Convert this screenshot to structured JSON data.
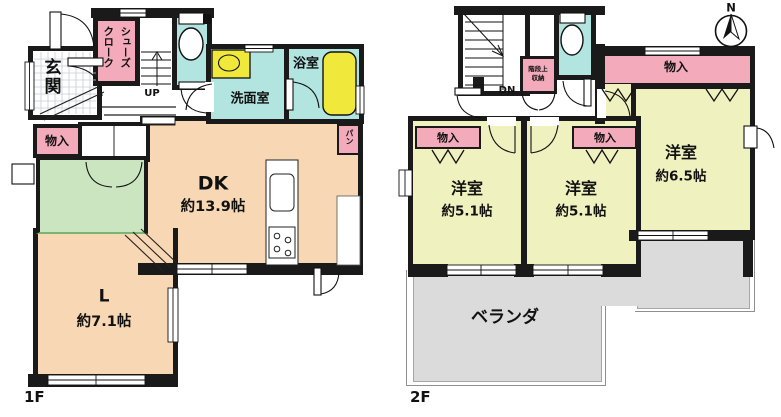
{
  "title": "間取り図 (floor plan)",
  "colors": {
    "wall": "#1a1a1a",
    "closet_pink": "#f3abbc",
    "wet_area_cyan": "#b2e4e0",
    "fixture_yellow": "#f0e93c",
    "ldk_peach": "#f8d8b4",
    "tatami_green": "#cbe5c0",
    "bedroom_yellow_green": "#eff1bf",
    "balcony_gray": "#dbdbdb"
  },
  "floor1": {
    "label": "1F",
    "entrance": "玄関",
    "shoe_closet_col1": "シューズ",
    "shoe_closet_col2": "クローク",
    "stairs": "UP",
    "washroom": "洗面室",
    "bathroom": "浴室",
    "storage": "物入",
    "pantry": "パン",
    "dining_kitchen": {
      "name": "DK",
      "size": "約13.9帖"
    },
    "living": {
      "name": "L",
      "size": "約7.1帖"
    }
  },
  "floor2": {
    "label": "2F",
    "stairs": "DN",
    "stair_storage": {
      "line1": "階段上",
      "line2": "収納"
    },
    "closet_room1": "物入",
    "closet_room2": "物入",
    "closet_room3": "物入",
    "room1": {
      "name": "洋室",
      "size": "約5.1帖"
    },
    "room2": {
      "name": "洋室",
      "size": "約5.1帖"
    },
    "room3": {
      "name": "洋室",
      "size": "約6.5帖"
    },
    "veranda": "ベランダ"
  },
  "compass": {
    "north_label": "N"
  }
}
